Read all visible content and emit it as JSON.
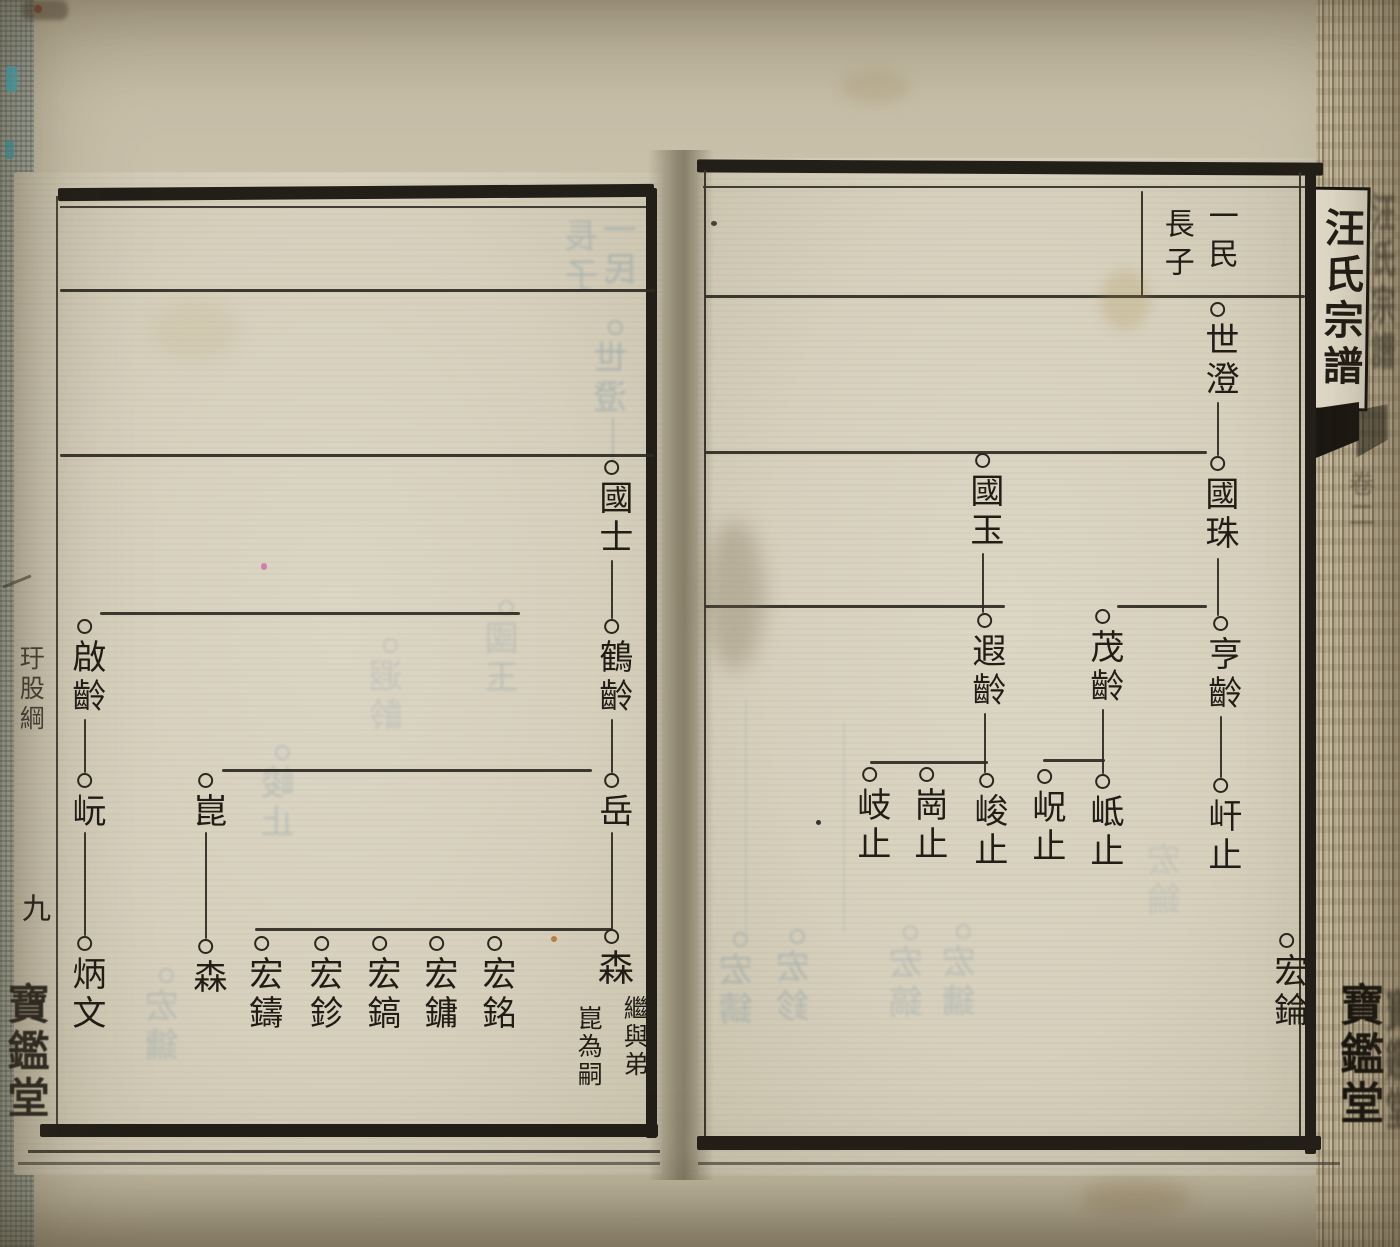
{
  "scene": {
    "width": 1400,
    "height": 1247
  },
  "spine": {
    "title": "汪氏宗譜",
    "volume_mark": "卷二",
    "hall": "寶鑑堂"
  },
  "left_margin": {
    "section": "玗股綱",
    "page_number": "九",
    "hall": "寶鑑堂"
  },
  "right_page": {
    "header": [
      {
        "text": "一民",
        "x": 1220,
        "y": 200,
        "size": 30
      },
      {
        "text": "長子",
        "x": 1176,
        "y": 208,
        "size": 30
      }
    ],
    "nodes": [
      {
        "chars": "世澄",
        "x": 1218,
        "cy": 310,
        "size": 34
      },
      {
        "chars": "國珠",
        "x": 1218,
        "cy": 464,
        "size": 34
      },
      {
        "chars": "國玉",
        "x": 983,
        "cy": 461,
        "size": 34
      },
      {
        "chars": "亨齡",
        "x": 1221,
        "cy": 624,
        "size": 34
      },
      {
        "chars": "茂齡",
        "x": 1103,
        "cy": 617,
        "size": 34
      },
      {
        "chars": "遐齡",
        "x": 985,
        "cy": 621,
        "size": 34
      },
      {
        "chars": "屽止",
        "x": 1221,
        "cy": 786,
        "size": 34
      },
      {
        "chars": "岻止",
        "x": 1103,
        "cy": 782,
        "size": 34
      },
      {
        "chars": "岲止",
        "x": 1045,
        "cy": 777,
        "size": 34
      },
      {
        "chars": "峻止",
        "x": 987,
        "cy": 781,
        "size": 34
      },
      {
        "chars": "崗止",
        "x": 927,
        "cy": 775,
        "size": 34
      },
      {
        "chars": "岐止",
        "x": 870,
        "cy": 775,
        "size": 34
      },
      {
        "chars": "宏錀",
        "x": 1287,
        "cy": 941,
        "size": 34
      }
    ],
    "hlines": [
      [
        705,
        295,
        600
      ],
      [
        705,
        451,
        502
      ],
      [
        705,
        605,
        300
      ],
      [
        1117,
        605,
        90
      ],
      [
        870,
        761,
        118
      ],
      [
        1043,
        759,
        62
      ]
    ],
    "vlines": [
      [
        1217,
        402,
        54
      ],
      [
        1217,
        558,
        58
      ],
      [
        982,
        553,
        60
      ],
      [
        1220,
        716,
        62
      ],
      [
        984,
        713,
        60
      ],
      [
        1102,
        709,
        65
      ],
      [
        1141,
        191,
        105
      ]
    ],
    "ghosts": [
      {
        "chars": "宏鑄",
        "x": 740,
        "cy": 940,
        "circle": true,
        "op": 0.38
      },
      {
        "chars": "宏鉁",
        "x": 797,
        "cy": 937,
        "circle": true,
        "op": 0.38
      },
      {
        "chars": "宏鎬",
        "x": 910,
        "cy": 933,
        "circle": true,
        "op": 0.3
      },
      {
        "chars": "宏鏞",
        "x": 963,
        "cy": 932,
        "circle": true,
        "op": 0.3
      },
      {
        "chars": "宏錀",
        "x": 1168,
        "cy": 850,
        "circle": false,
        "op": 0.2
      }
    ],
    "ghost_vlines": [
      [
        745,
        700,
        235,
        0.16
      ],
      [
        843,
        722,
        210,
        0.16
      ]
    ]
  },
  "left_page": {
    "nodes": [
      {
        "chars": "國士",
        "x": 612,
        "cy": 468,
        "size": 34
      },
      {
        "chars": "鶴齡",
        "x": 612,
        "cy": 627,
        "size": 34
      },
      {
        "chars": "啟齡",
        "x": 85,
        "cy": 627,
        "size": 34
      },
      {
        "chars": "岳",
        "x": 612,
        "cy": 781,
        "size": 34
      },
      {
        "chars": "崑",
        "x": 206,
        "cy": 781,
        "size": 34
      },
      {
        "chars": "岏",
        "x": 85,
        "cy": 781,
        "size": 34
      },
      {
        "chars": "森",
        "x": 612,
        "cy": 937,
        "size": 36,
        "note": {
          "cols": [
            "繼與弟",
            "崑為嗣"
          ],
          "dx": [
            8,
            -38
          ],
          "dy": [
            58,
            68
          ],
          "size": 25
        }
      },
      {
        "chars": "宏銘",
        "x": 495,
        "cy": 944,
        "size": 34
      },
      {
        "chars": "宏鏞",
        "x": 437,
        "cy": 944,
        "size": 34
      },
      {
        "chars": "宏鎬",
        "x": 380,
        "cy": 944,
        "size": 34
      },
      {
        "chars": "宏鉁",
        "x": 322,
        "cy": 944,
        "size": 34
      },
      {
        "chars": "宏鑄",
        "x": 262,
        "cy": 944,
        "size": 34
      },
      {
        "chars": "森",
        "x": 206,
        "cy": 947,
        "size": 34
      },
      {
        "chars": "炳文",
        "x": 85,
        "cy": 944,
        "size": 34
      }
    ],
    "small_marks": [
      {
        "ch": "嗣",
        "x": 217,
        "y": 872,
        "size": 17
      },
      {
        "ch": "子",
        "x": 192,
        "y": 877,
        "size": 17
      }
    ],
    "hlines": [
      [
        60,
        289,
        595
      ],
      [
        60,
        454,
        594
      ],
      [
        100,
        612,
        420
      ],
      [
        222,
        769,
        370
      ],
      [
        255,
        928,
        358
      ]
    ],
    "vlines": [
      [
        611,
        560,
        59
      ],
      [
        611,
        719,
        54
      ],
      [
        84,
        719,
        54
      ],
      [
        611,
        832,
        97
      ],
      [
        84,
        832,
        104
      ],
      [
        205,
        832,
        107
      ]
    ],
    "ghosts": [
      {
        "chars": "一民",
        "x": 624,
        "cy": 220,
        "circle": false,
        "op": 0.4
      },
      {
        "chars": "長子",
        "x": 586,
        "cy": 226,
        "circle": false,
        "op": 0.36
      },
      {
        "chars": "世澄",
        "x": 615,
        "cy": 328,
        "circle": true,
        "op": 0.42
      },
      {
        "chars": "國玉",
        "x": 506,
        "cy": 608,
        "circle": true,
        "op": 0.28
      },
      {
        "chars": "遐齡",
        "x": 390,
        "cy": 646,
        "circle": true,
        "op": 0.24
      },
      {
        "chars": "峻止",
        "x": 282,
        "cy": 753,
        "circle": true,
        "op": 0.3
      },
      {
        "chars": "宏鏞",
        "x": 166,
        "cy": 976,
        "circle": true,
        "op": 0.3
      }
    ],
    "ghost_vlines": [
      [
        612,
        418,
        46,
        0.35
      ]
    ]
  }
}
